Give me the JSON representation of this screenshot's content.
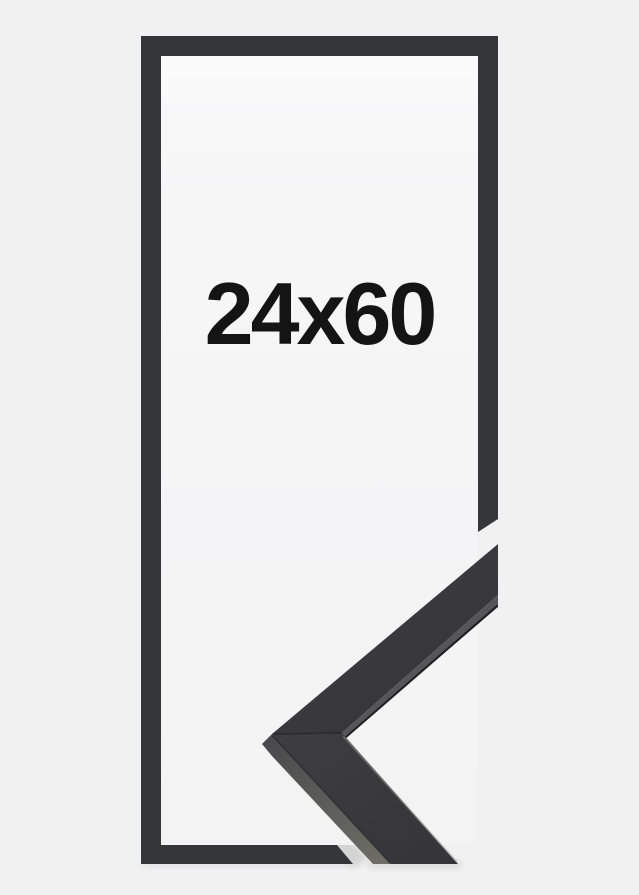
{
  "product_image": {
    "size_label": "24x60",
    "colors": {
      "background": "#f1f1f2",
      "inner_background": "#f6f6f7",
      "frame_border": "#353639",
      "molding_top": "#3a3a3d",
      "molding_side": "#65655f",
      "molding_lip": "#56565a",
      "label_text": "#141414"
    }
  }
}
